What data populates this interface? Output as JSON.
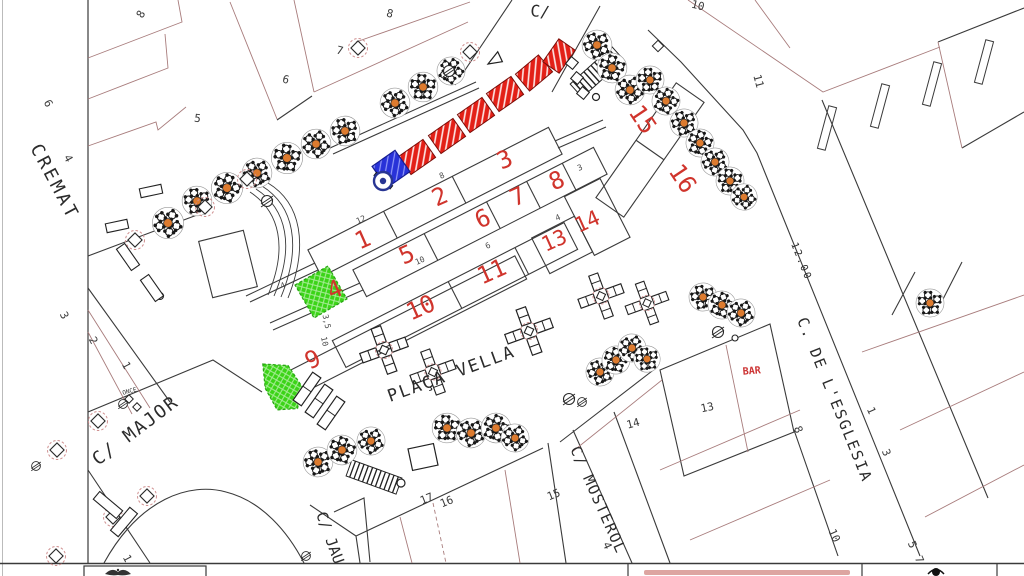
{
  "plan": {
    "place_name": "PLAÇA VELLA"
  },
  "streets": {
    "top": "C/",
    "cremat": "CREMAT",
    "major": "C/ MAJOR",
    "placa_vella": "PLAÇA VELLA",
    "mosterol": "C/ MOSTEROL",
    "esglesia": "C. DE L'ESGLESIA",
    "jaume": "C/ JAU",
    "esglesia_width": "12.00"
  },
  "poi": {
    "bar": "BAR",
    "once": "ONCE"
  },
  "red_zone_numbers": [
    "1",
    "2",
    "3",
    "4",
    "5",
    "6",
    "7",
    "8",
    "9",
    "10",
    "11",
    "13",
    "14",
    "15",
    "16"
  ],
  "parcel_numbers": [
    "8",
    "6",
    "4",
    "5",
    "6",
    "7",
    "8",
    "10",
    "11",
    "3",
    "2",
    "1",
    "1",
    "17",
    "16",
    "15",
    "4",
    "14",
    "13",
    "8",
    "1",
    "3",
    "10",
    "5",
    "7"
  ],
  "dimension_labels": [
    "12",
    "10",
    "8",
    "6",
    "4",
    "3",
    "3,5",
    "10",
    "4"
  ],
  "colors": {
    "zone_number_red": "#d0342c",
    "stall_fill_red": "#e32017",
    "monument_blue": "#2832d8",
    "zone_green": "#3bd417",
    "table_dot_orange": "#dd7b2f",
    "building_line_red": "#a87c7c",
    "line_black": "#3a3a3a",
    "tree_ring_pink": "#cf8f8f"
  }
}
